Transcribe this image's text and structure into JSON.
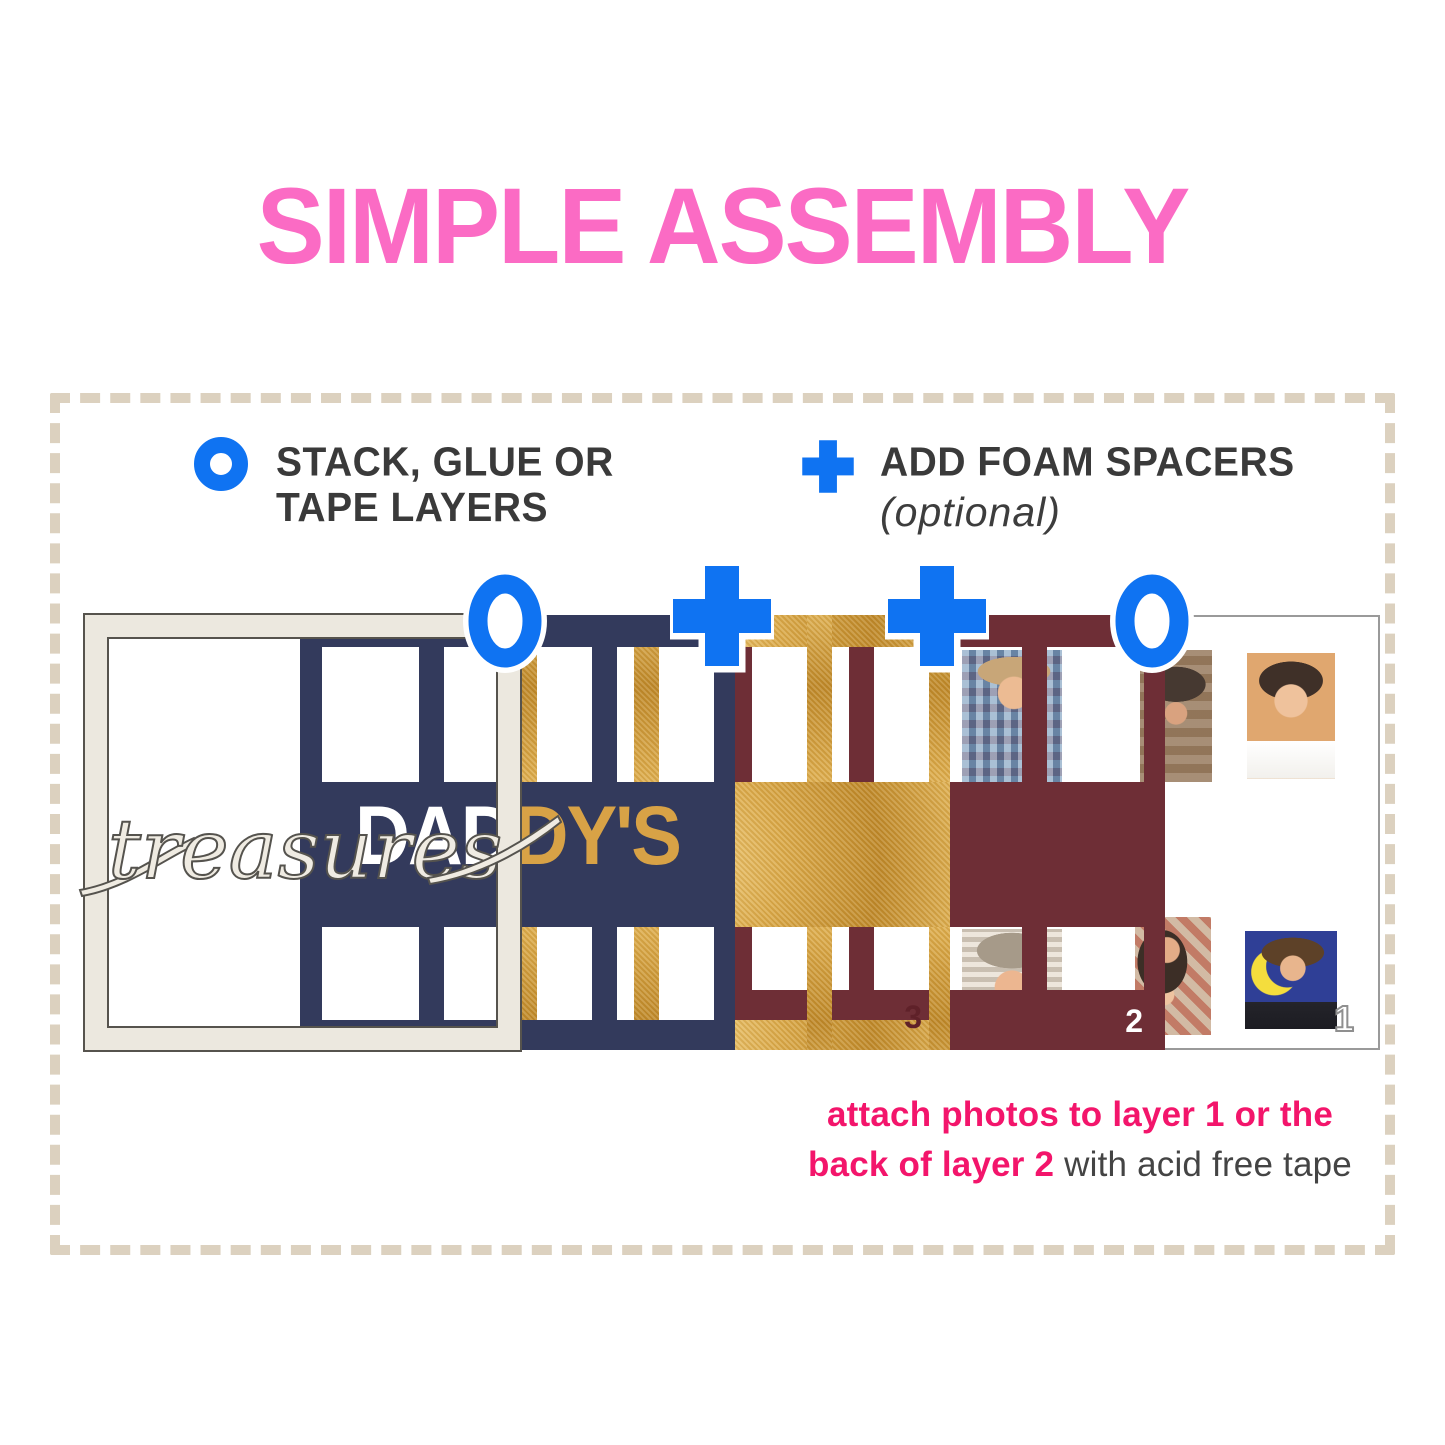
{
  "title": "SIMPLE ASSEMBLY",
  "legend": {
    "stack_icon": "ring-icon",
    "stack_line1": "STACK, GLUE OR",
    "stack_line2": "TAPE LAYERS",
    "foam_icon": "plus-icon",
    "foam_label": "ADD FOAM SPACERS",
    "foam_note": "(optional)"
  },
  "stack": {
    "script_word": "treasures",
    "cutout_word_left": "DAD",
    "cutout_word_right": "DY'S",
    "connector_icons": [
      "ring-icon",
      "plus-icon",
      "plus-icon",
      "ring-icon"
    ],
    "layers": [
      {
        "id": "frame-layer"
      },
      {
        "id": "navy-letter-layer"
      },
      {
        "id": "gold-layer",
        "number": "3"
      },
      {
        "id": "maroon-layer",
        "number": "2"
      },
      {
        "id": "white-backing-layer",
        "number": "1"
      }
    ]
  },
  "footnote": {
    "line1": "attach photos to layer 1 or the",
    "line2_highlight": "back of layer 2",
    "line2_rest": " with acid free tape"
  },
  "colors": {
    "title_pink": "#fb6bc4",
    "accent_blue": "#0f73f2",
    "navy": "#333a5c",
    "gold": "#d49e3f",
    "maroon": "#6e2e36",
    "cream": "#ece8df",
    "footnote_pink": "#f3156b",
    "dash": "#dcd1bf",
    "ink": "#3a3a3a"
  }
}
